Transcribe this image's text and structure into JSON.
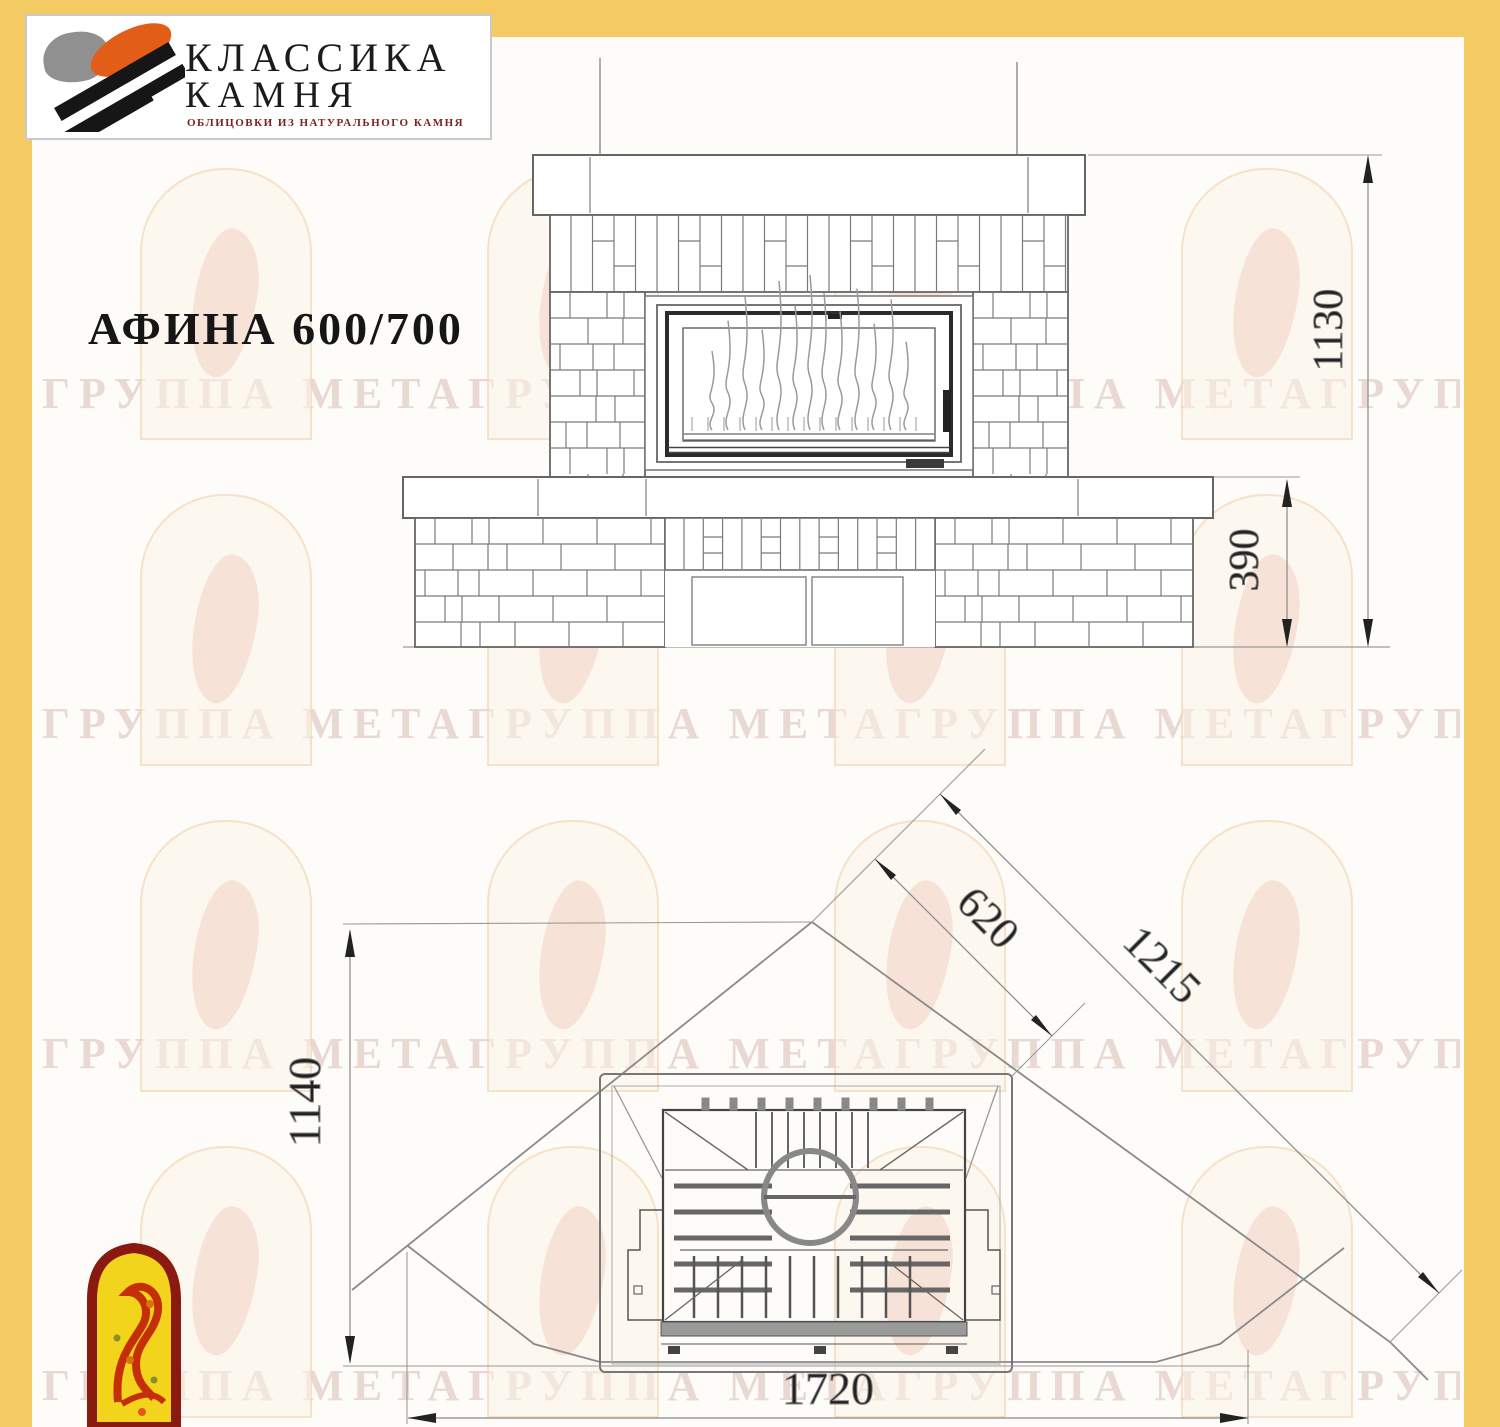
{
  "page": {
    "background": "#fdfcf9",
    "frame_color": "#f4ca63"
  },
  "logo": {
    "line1": "КЛАССИКА",
    "line2": "КАМНЯ",
    "tagline": "ОБЛИЦОВКИ ИЗ НАТУРАЛЬНОГО КАМНЯ"
  },
  "title": "АФИНА 600/700",
  "watermark": {
    "text": "ГРУППА МЕТАГРУППА МЕТАГРУППА МЕТАГРУППА МЕТАГРУППА МЕТАГРУППА МЕТА"
  },
  "front_view": {
    "dim_total_height": "1130",
    "dim_plinth_height": "390"
  },
  "plan_view": {
    "dim_depth": "1140",
    "dim_front_width": "1720",
    "dim_corner_to_insert": "620",
    "dim_corner_to_front": "1215"
  }
}
